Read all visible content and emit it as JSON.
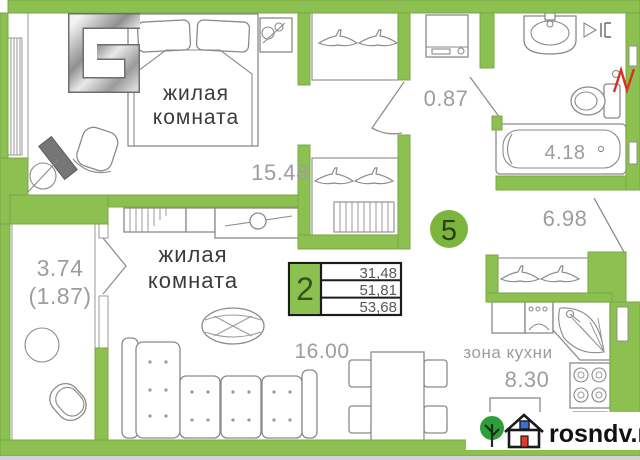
{
  "colors": {
    "wall_green": "#8CC152",
    "badge_green": "#7CB53E",
    "line_gray": "#8f8f8f",
    "area_text_gray": "#9d9d9d",
    "room_text_dark": "#3b3b3b",
    "logo_tree_green": "#2e9e38",
    "logo_door_red": "#e03a2f",
    "logo_window_blue": "#3a6fd8",
    "red_mark": "#d93025"
  },
  "badge": {
    "value": "5"
  },
  "developer_logo": {
    "icon": "chrome-5"
  },
  "rooms": {
    "bedroom": {
      "line1": "жилая",
      "line2": "комната",
      "area": "15.48"
    },
    "living": {
      "line1": "жилая",
      "line2": "комната",
      "area": "16.00"
    },
    "hall": {
      "area": "6.98"
    },
    "bath": {
      "area": "4.18"
    },
    "wc": {
      "area": "0.87"
    },
    "kitchen": {
      "label": "зона кухни",
      "area": "8.30"
    },
    "balcony": {
      "area": "3.74",
      "area_coeff": "(1.87)"
    }
  },
  "summary": {
    "rooms": "2",
    "living_area": "31,48",
    "area": "51,81",
    "total_area": "53,68"
  },
  "watermark": {
    "site": "rosndv.ru"
  }
}
